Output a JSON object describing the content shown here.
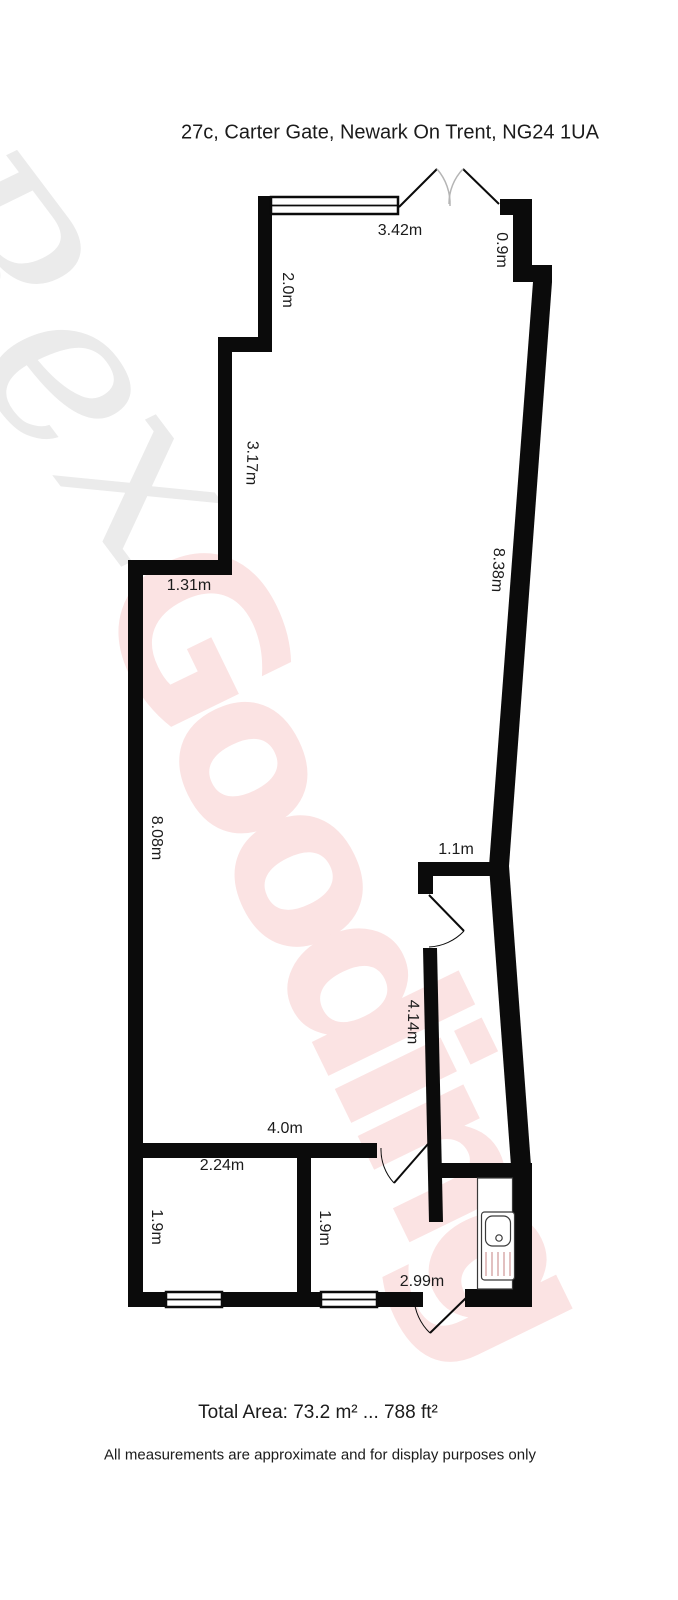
{
  "title": "27c, Carter Gate, Newark On Trent, NG24 1UA",
  "watermark": {
    "word1": "Rex",
    "word2": "Gooding",
    "gray_color": "#ebebeb",
    "pink_color": "#fbe3e3"
  },
  "plan": {
    "wall_color": "#0b0b0b",
    "measurements": [
      {
        "label": "3.42m"
      },
      {
        "label": "0.9m"
      },
      {
        "label": "2.0m"
      },
      {
        "label": "3.17m"
      },
      {
        "label": "8.38m"
      },
      {
        "label": "1.31m"
      },
      {
        "label": "8.08m"
      },
      {
        "label": "1.1m"
      },
      {
        "label": "4.14m"
      },
      {
        "label": "4.0m"
      },
      {
        "label": "2.24m"
      },
      {
        "label": "1.9m"
      },
      {
        "label": "1.9m"
      },
      {
        "label": "2.99m"
      }
    ]
  },
  "footer": {
    "total_area": "Total Area: 73.2 m² ... 788 ft²",
    "disclaimer": "All measurements are approximate and for display purposes only"
  }
}
